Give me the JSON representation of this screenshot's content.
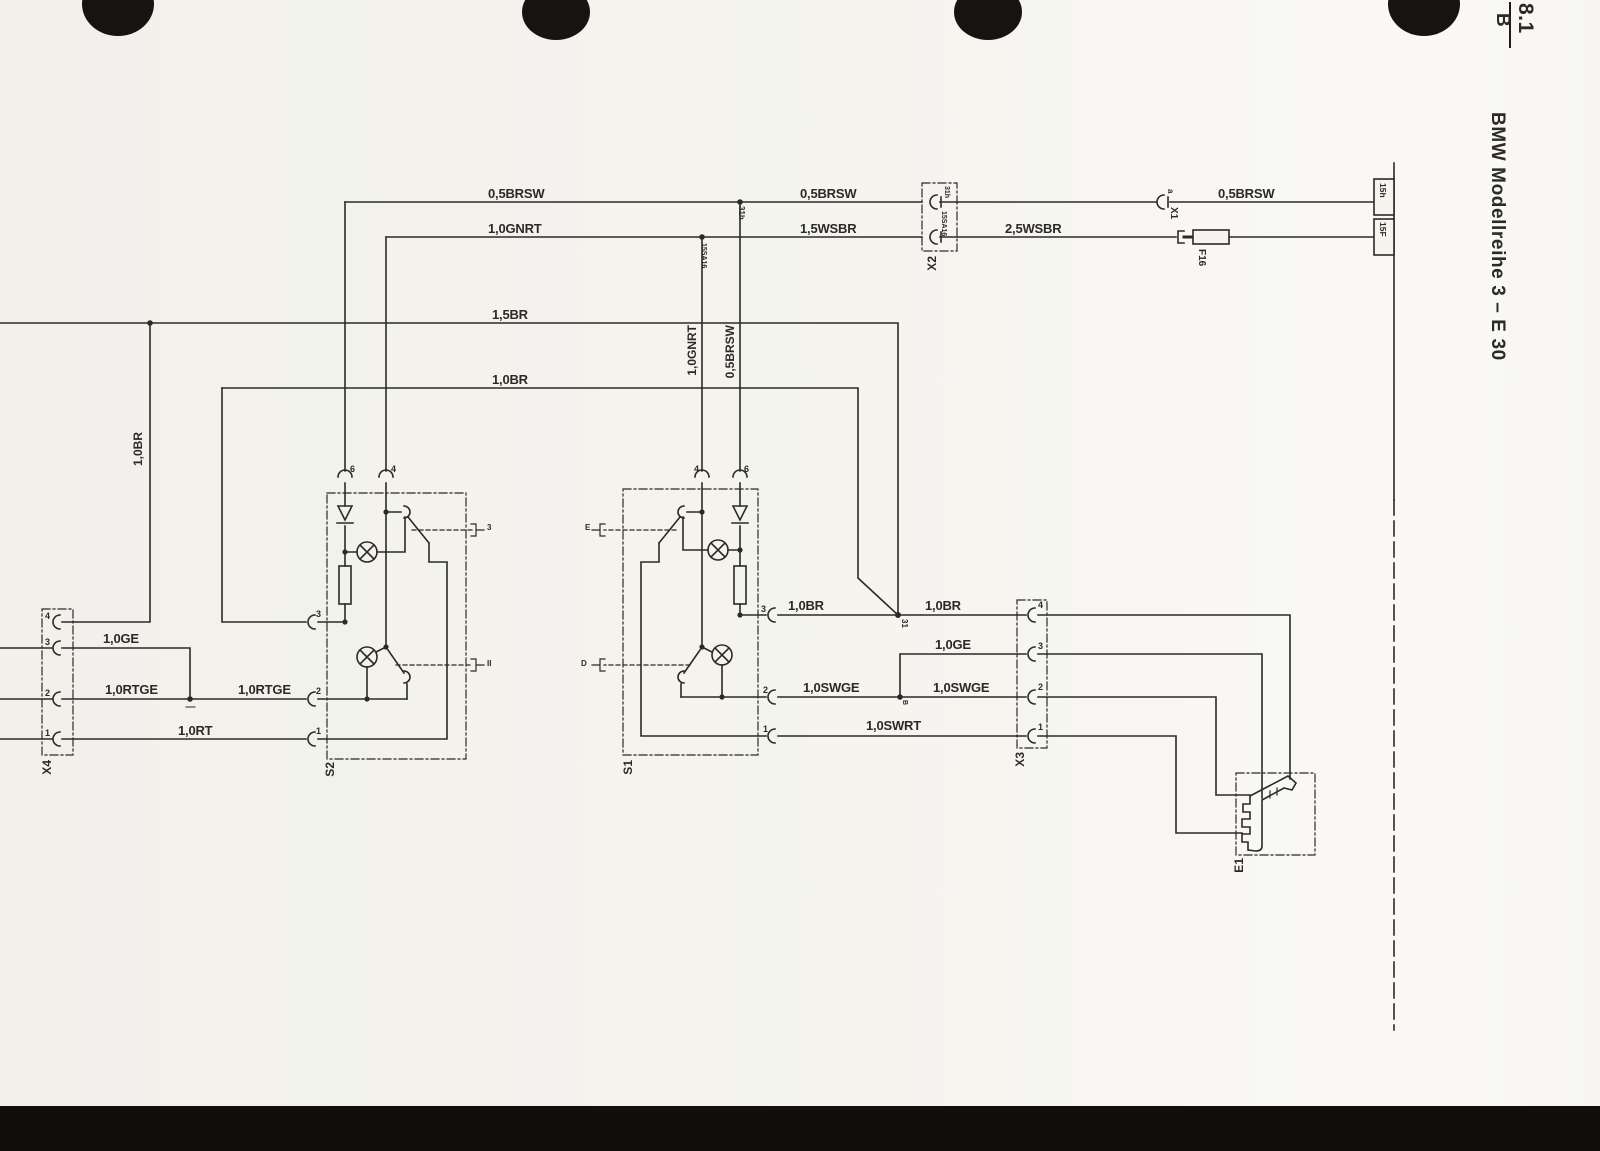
{
  "header": {
    "section": "8.1",
    "page_letter": "B",
    "title": "BMW Modellreihe 3 – E 30"
  },
  "labels": {
    "brsw05": "0,5BRSW",
    "gnrt10": "1,0GNRT",
    "wsbr15": "1,5WSBR",
    "wsbr25": "2,5WSBR",
    "br15": "1,5BR",
    "br10": "1,0BR",
    "ge10": "1,0GE",
    "rtge10": "1,0RTGE",
    "rt10": "1,0RT",
    "swge10": "1,0SWGE",
    "swrt10": "1,0SWRT"
  },
  "components": {
    "x1": "X1",
    "x2": "X2",
    "x3": "X3",
    "x4": "X4",
    "s1": "S1",
    "s2": "S2",
    "e1": "E1",
    "f16": "F16",
    "t15h": "15h",
    "t15f": "15F"
  },
  "pins": {
    "p1": "1",
    "p2": "2",
    "p3": "3",
    "p4": "4",
    "p6": "6"
  },
  "codes": {
    "c31h": "31h",
    "c15sa16": "15SA16",
    "c31": "31",
    "cB": "B",
    "x1pin": "a",
    "s2_upper": "3",
    "s2_lower": "II",
    "s1_upper": "E",
    "s1_lower": "D"
  },
  "colors": {
    "ink": "#2b2a27",
    "paper": "#f5f4ef",
    "bar": "#100f0d"
  }
}
